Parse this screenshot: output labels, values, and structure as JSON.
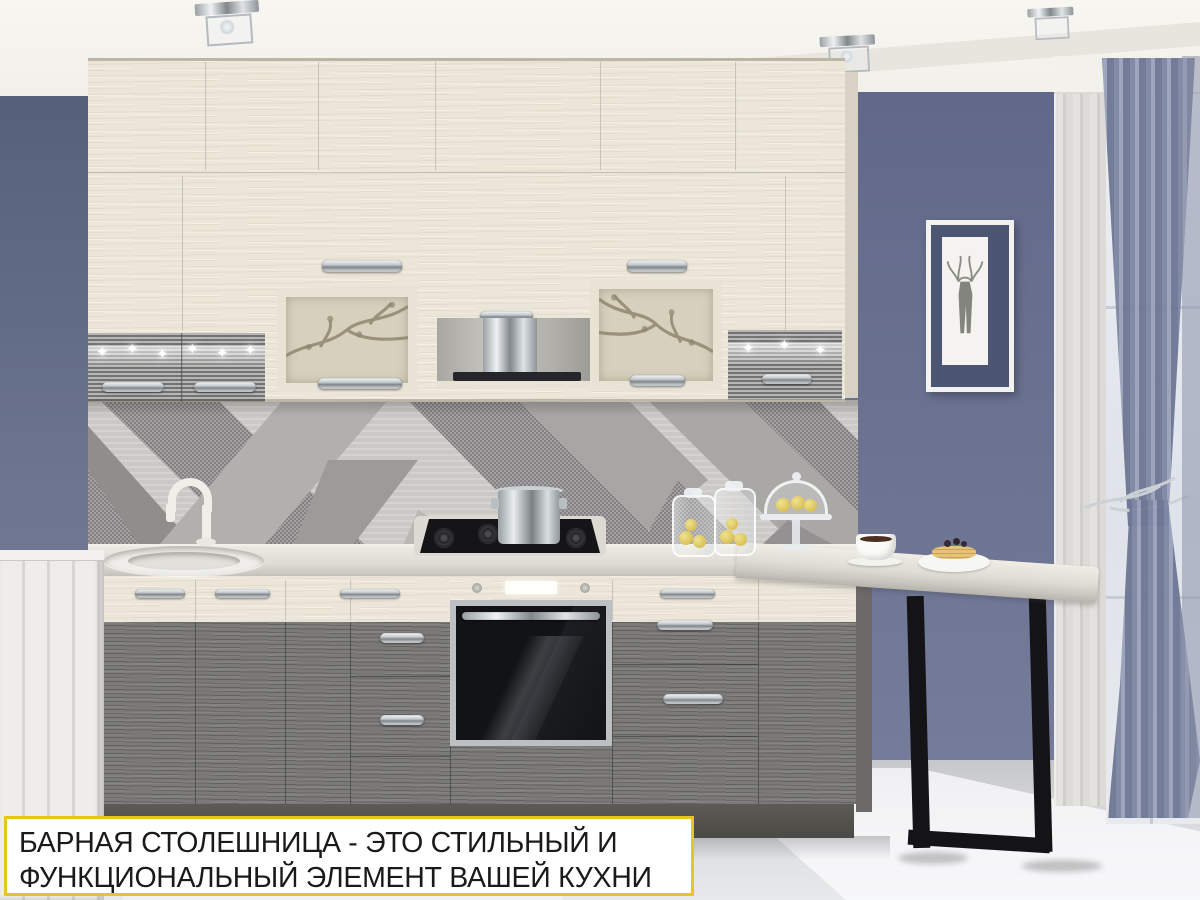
{
  "banner": {
    "line1": "БАРНАЯ СТОЛЕШНИЦА - ЭТО СТИЛЬНЫЙ И",
    "line2": "ФУНКЦИОНАЛЬНЫЙ ЭЛЕМЕНТ ВАШЕЙ КУХНИ",
    "border_color": "#e9c51e",
    "background": "#ffffff",
    "text_color": "#1a1a1a"
  },
  "scene": {
    "alt": "Corner kitchen: cream textured upper cabinets with glass doors, gray sparkle accent doors, geometric gray backsplash, gas hob with pot, built-in oven, gray lower drawers, sink, bar countertop on black metal frame leg, blue-gray walls, deer picture, window with blue curtains",
    "palette": {
      "wall_blue": "#6a7190",
      "ceiling": "#f5f3ee",
      "cabinet_cream": "#ece6d9",
      "cabinet_gray": "#7b7a78",
      "sparkle_gray": "#8f8f8d",
      "countertop": "#dddbd3",
      "backsplash_base": "#cbc9c5",
      "metal_leg": "#17171a",
      "floor": "#d6d7d9",
      "curtain": "#8790aa"
    }
  }
}
